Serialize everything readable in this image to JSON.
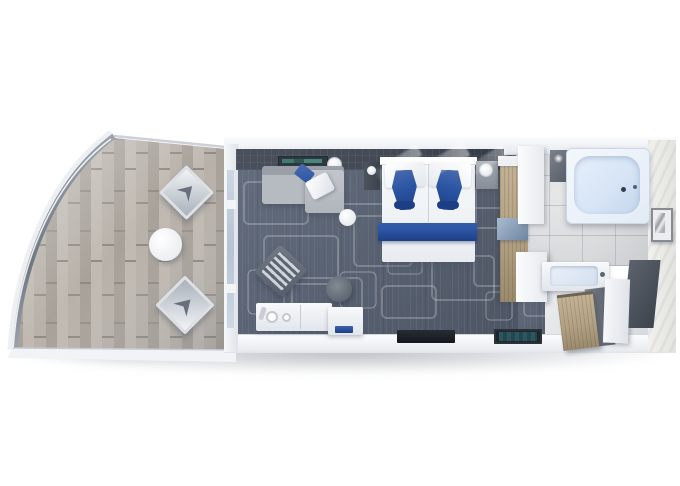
{
  "scene": {
    "type": "floorplan-render",
    "view": "top-down-3d",
    "subject": "cruise-ship-suite",
    "rooms": [
      {
        "name": "balcony",
        "furniture": [
          "glass-railing",
          "lounge-chair",
          "lounge-chair",
          "round-table"
        ],
        "floor": "wood-deck"
      },
      {
        "name": "living-area",
        "furniture": [
          "sofa",
          "blue-pillow",
          "white-throw",
          "armchair",
          "ottoman",
          "minibar-console",
          "side-table",
          "coffee-table",
          "tv-shelf",
          "floor-lamp"
        ],
        "floor": "patterned-carpet"
      },
      {
        "name": "bedroom",
        "furniture": [
          "double-bed",
          "white-pillows",
          "blue-pillows",
          "blue-bed-runner",
          "nightstand-left",
          "nightstand-right",
          "wardrobe",
          "vanity-shelf"
        ],
        "floor": "patterned-carpet"
      },
      {
        "name": "bathroom",
        "furniture": [
          "bathtub",
          "shower",
          "vanity-sink",
          "wall-picture",
          "storage-tower"
        ],
        "floor": "marble-tile"
      },
      {
        "name": "entrance",
        "furniture": [
          "entry-closet",
          "entry-door",
          "doormat-dark",
          "doormat-teal"
        ],
        "floor": "carpet-and-threshold"
      }
    ]
  },
  "colors": {
    "background": "#ffffff",
    "carpet": "#5a6373",
    "wall": "#f3f5f7",
    "dark_wall": "#434a56",
    "deck_wood": "#aea89f",
    "closet_wood": "#b2a184",
    "marble": "#d8d9db",
    "accent_blue": "#2c55a3",
    "accent_blue_dark": "#1d3f85",
    "tub_blue": "#d7e5f6",
    "sofa_gray": "#b6bac1",
    "shadow": "#9aa2ae"
  }
}
